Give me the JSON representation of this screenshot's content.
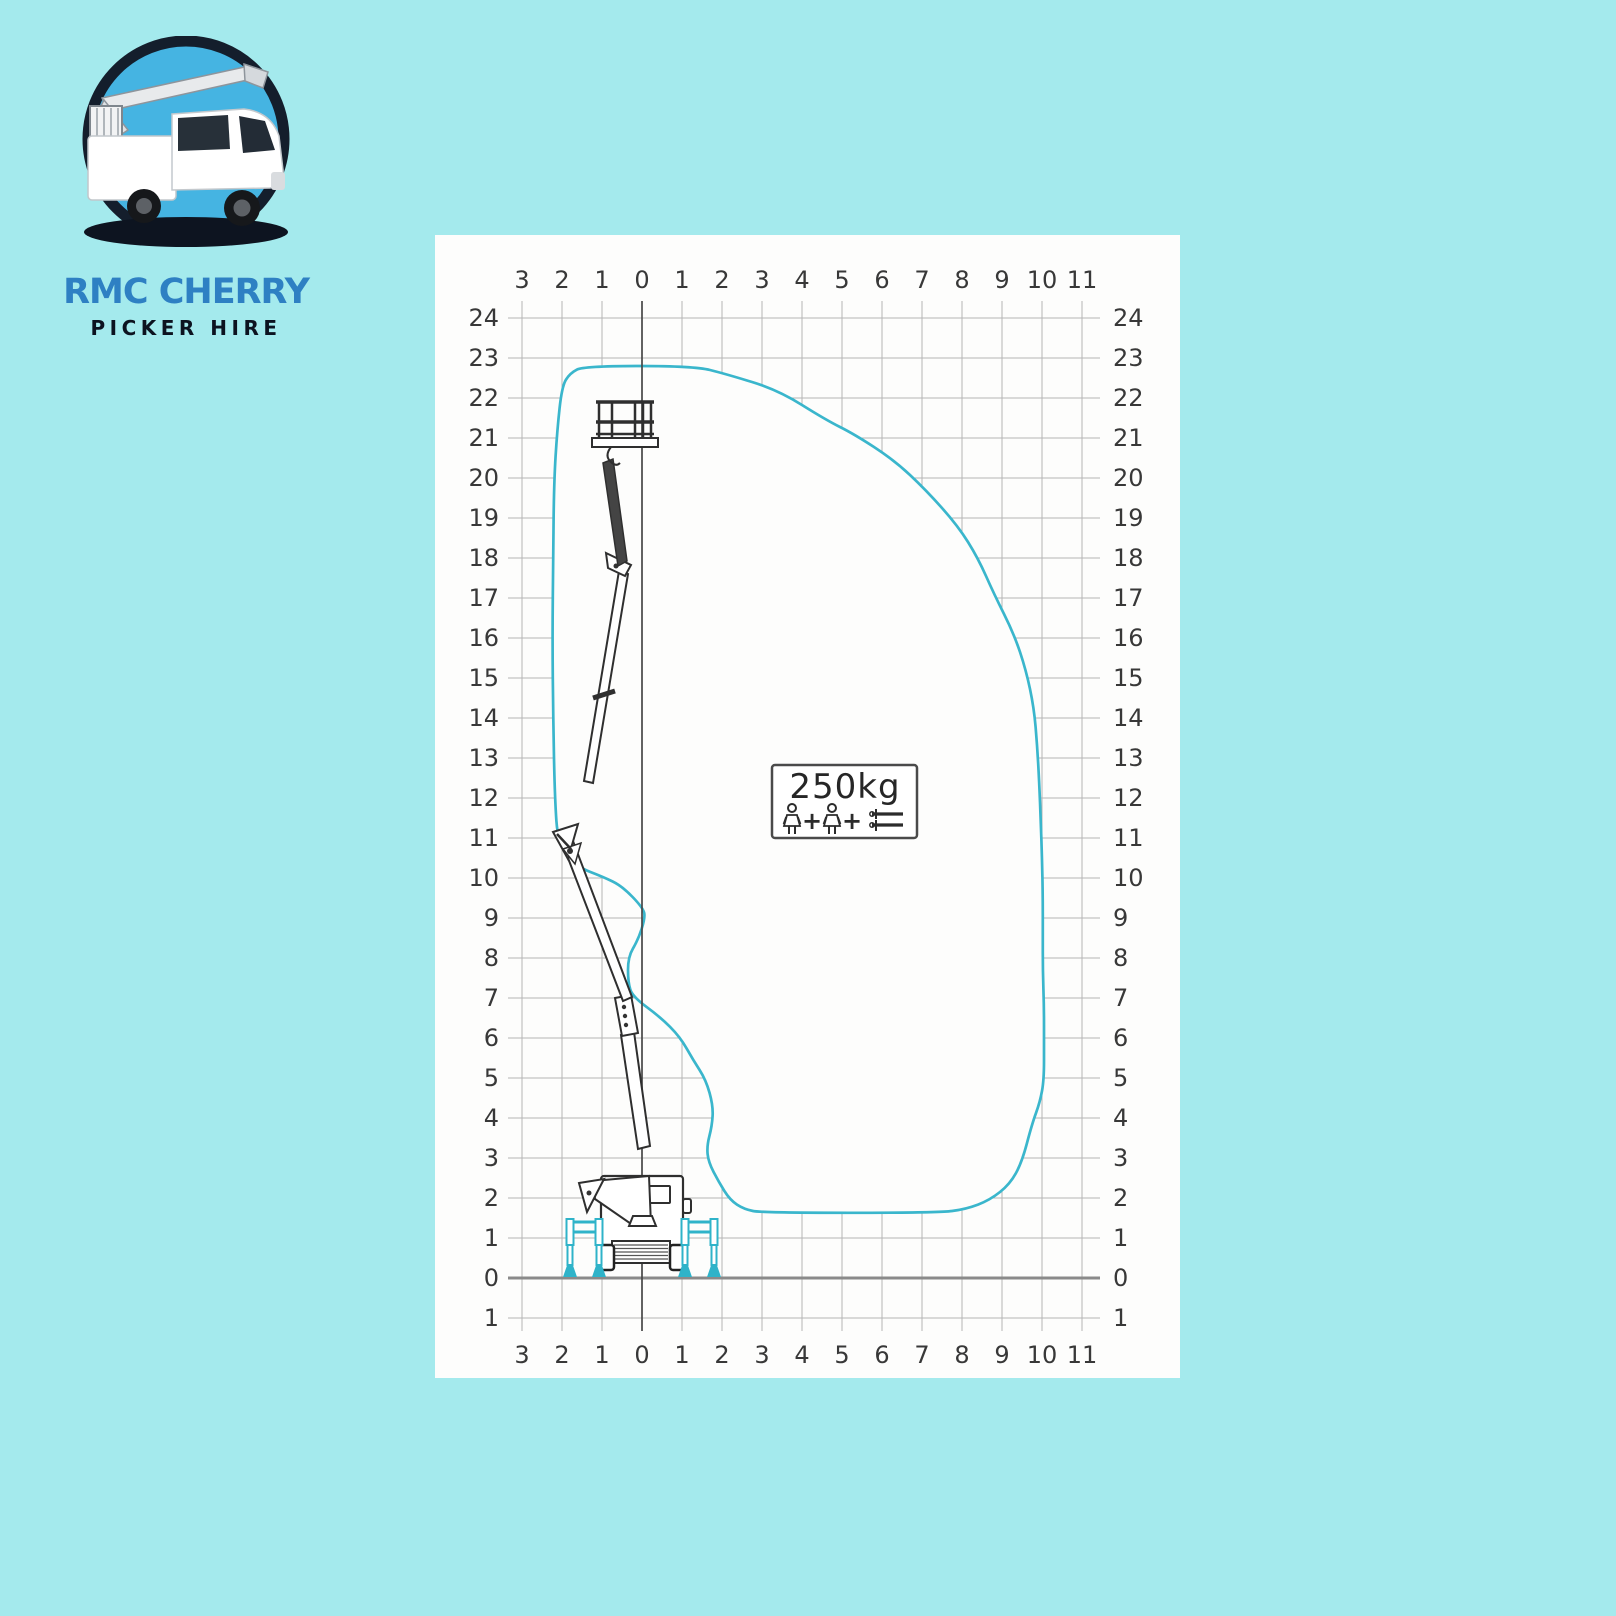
{
  "page": {
    "background_color": "#a4eaed"
  },
  "logo": {
    "title": "RMC CHERRY",
    "subtitle": "PICKER HIRE",
    "title_color": "#2e80c3",
    "subtitle_color": "#0c1320",
    "emblem": "cherry-picker-truck-in-circle"
  },
  "diagram": {
    "panel_bg": "#fdfdfc",
    "grid_color": "#b5b5b5",
    "axis_color": "#474747",
    "ground_color": "#8a8a8a",
    "label_color": "#383838",
    "envelope_color": "#3ab6cc",
    "outrigger_color": "#2fb3c9",
    "x_min": -3,
    "x_max": 11,
    "y_min": -1,
    "y_max": 24,
    "top_axis_labels": [
      "3",
      "2",
      "1",
      "0",
      "1",
      "2",
      "3",
      "4",
      "5",
      "6",
      "7",
      "8",
      "9",
      "10",
      "11"
    ],
    "bottom_axis_labels": [
      "3",
      "2",
      "1",
      "0",
      "1",
      "2",
      "3",
      "4",
      "5",
      "6",
      "7",
      "8",
      "9",
      "10",
      "11"
    ],
    "left_axis_labels": [
      "24",
      "23",
      "22",
      "21",
      "20",
      "19",
      "18",
      "17",
      "16",
      "15",
      "14",
      "13",
      "12",
      "11",
      "10",
      "9",
      "8",
      "7",
      "6",
      "5",
      "4",
      "3",
      "2",
      "1",
      "0",
      "1"
    ],
    "right_axis_labels": [
      "24",
      "23",
      "22",
      "21",
      "20",
      "19",
      "18",
      "17",
      "16",
      "15",
      "14",
      "13",
      "12",
      "11",
      "10",
      "9",
      "8",
      "7",
      "6",
      "5",
      "4",
      "3",
      "2",
      "1",
      "0",
      "1"
    ],
    "load_box": {
      "label": "250kg",
      "icons": [
        "person",
        "plus",
        "person",
        "plus",
        "tools"
      ]
    },
    "envelope_points": [
      [
        -1.45,
        22.8
      ],
      [
        1.3,
        22.8
      ],
      [
        2.1,
        22.6
      ],
      [
        3.4,
        22.2
      ],
      [
        4.6,
        21.45
      ],
      [
        5.3,
        21.1
      ],
      [
        6.3,
        20.45
      ],
      [
        7.1,
        19.7
      ],
      [
        7.9,
        18.8
      ],
      [
        8.4,
        18.0
      ],
      [
        8.8,
        17.1
      ],
      [
        9.3,
        16.1
      ],
      [
        9.6,
        15.2
      ],
      [
        9.8,
        14.25
      ],
      [
        9.88,
        13.3
      ],
      [
        9.93,
        12.4
      ],
      [
        9.97,
        11.4
      ],
      [
        10.0,
        10.5
      ],
      [
        10.02,
        9.55
      ],
      [
        10.02,
        8.6
      ],
      [
        10.02,
        7.68
      ],
      [
        10.05,
        6.78
      ],
      [
        10.05,
        5.87
      ],
      [
        10.05,
        4.95
      ],
      [
        9.95,
        4.4
      ],
      [
        9.75,
        3.85
      ],
      [
        9.5,
        2.9
      ],
      [
        9.2,
        2.35
      ],
      [
        8.7,
        1.95
      ],
      [
        8.1,
        1.72
      ],
      [
        7.4,
        1.63
      ],
      [
        3.0,
        1.63
      ],
      [
        2.55,
        1.72
      ],
      [
        2.2,
        1.95
      ],
      [
        1.92,
        2.4
      ],
      [
        1.66,
        2.9
      ],
      [
        1.62,
        3.3
      ],
      [
        1.75,
        3.8
      ],
      [
        1.78,
        4.3
      ],
      [
        1.6,
        4.95
      ],
      [
        1.28,
        5.45
      ],
      [
        0.95,
        6.03
      ],
      [
        0.45,
        6.53
      ],
      [
        -0.23,
        7.03
      ],
      [
        -0.35,
        7.38
      ],
      [
        -0.35,
        8.03
      ],
      [
        -0.1,
        8.45
      ],
      [
        0.08,
        9.0
      ],
      [
        0.03,
        9.25
      ],
      [
        -0.5,
        9.8
      ],
      [
        -0.98,
        10.03
      ],
      [
        -1.63,
        10.28
      ],
      [
        -2.1,
        10.85
      ],
      [
        -2.18,
        12.0
      ],
      [
        -2.22,
        14.0
      ],
      [
        -2.24,
        16.0
      ],
      [
        -2.22,
        18.0
      ],
      [
        -2.2,
        19.9
      ],
      [
        -2.12,
        21.2
      ],
      [
        -2.0,
        22.3
      ],
      [
        -1.8,
        22.62
      ]
    ]
  }
}
